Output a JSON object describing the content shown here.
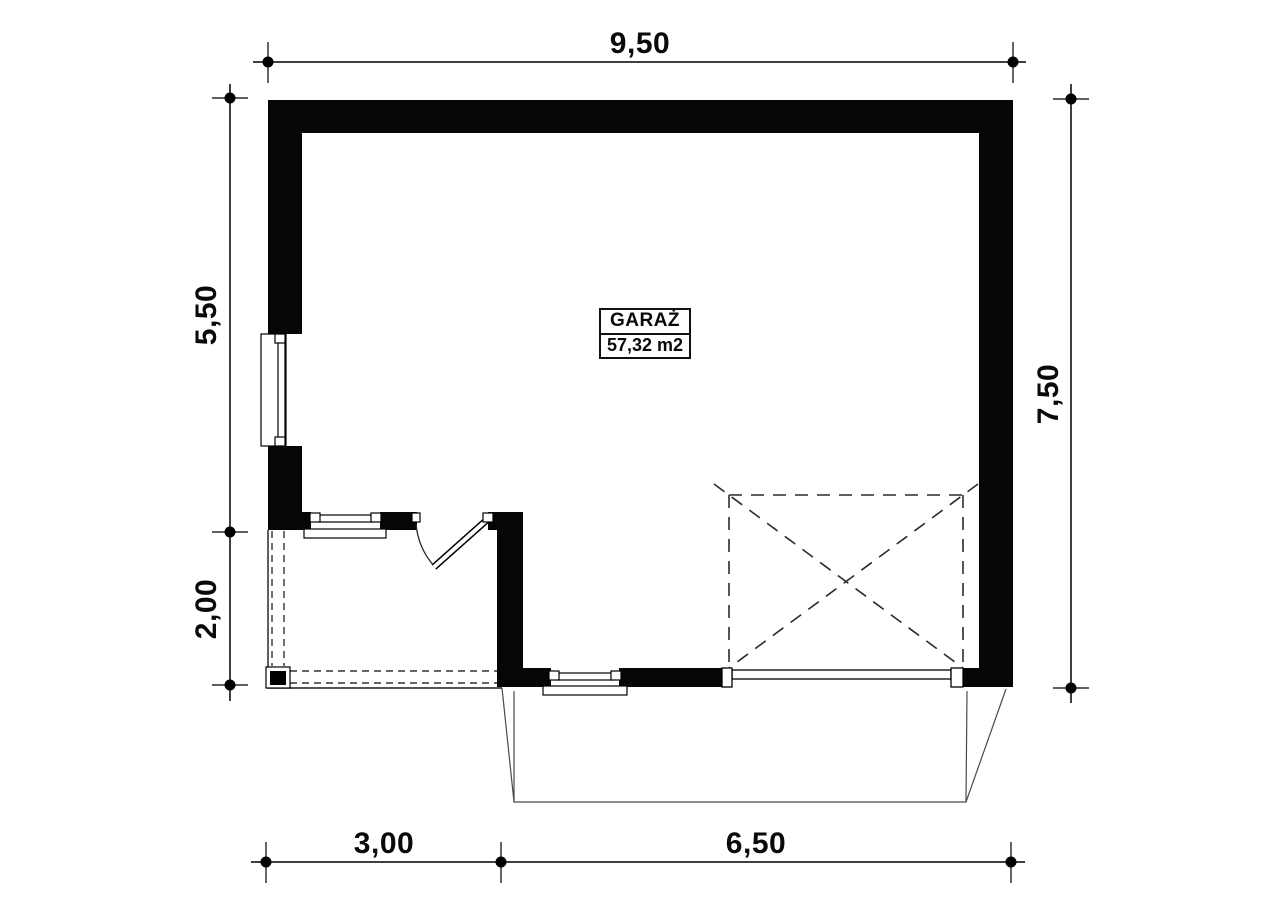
{
  "room_label": {
    "name": "GARAŻ",
    "area": "57,32 m2"
  },
  "dimensions": {
    "top": "9,50",
    "left_upper": "5,50",
    "left_lower": "2,00",
    "right": "7,50",
    "bottom_left": "3,00",
    "bottom_right": "6,50"
  },
  "colors": {
    "ink": "#000000",
    "wall_fill": "#060606",
    "background": "#ffffff",
    "dashed_line": "#2b2b2b",
    "apron_line": "#4a4a4a"
  }
}
